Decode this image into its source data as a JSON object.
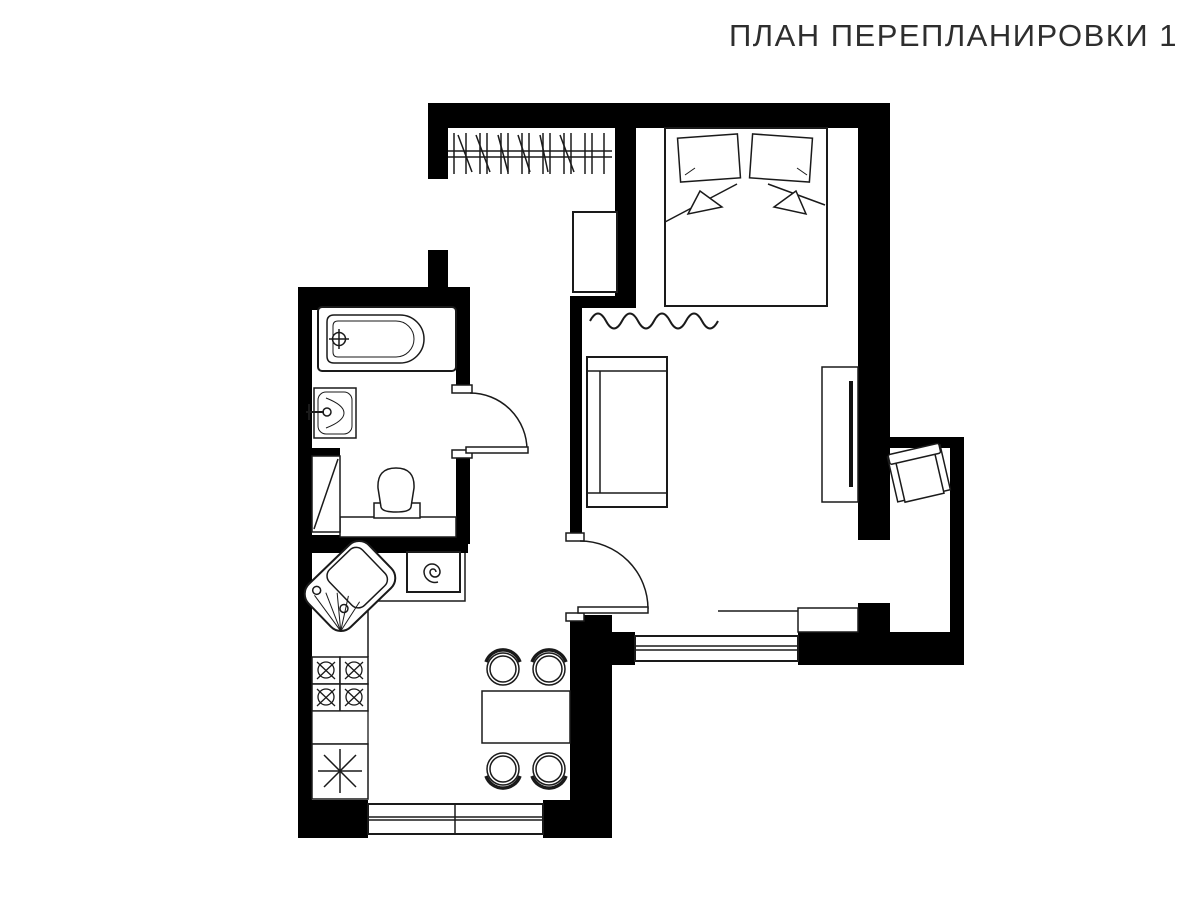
{
  "header": {
    "title": "ПЛАН ПЕРЕПЛАНИРОВКИ 1"
  },
  "colors": {
    "walls": "#000000",
    "furniture_lines": "#1a1a1a",
    "background": "#ffffff"
  },
  "floor_plan": {
    "type": "apartment-replanning-plan",
    "sheet_number": "1",
    "rooms": [
      {
        "name": "hallway",
        "fixtures": [
          "wardrobe-hanger-rail",
          "dresser"
        ]
      },
      {
        "name": "bedroom",
        "fixtures": [
          "double-bed",
          "pillow-left",
          "pillow-right",
          "blanket-folds"
        ]
      },
      {
        "name": "bathroom",
        "fixtures": [
          "bathtub",
          "bathtub-faucet",
          "washbasin",
          "toilet",
          "vent-shaft"
        ]
      },
      {
        "name": "kitchen",
        "fixtures": [
          "corner-sink",
          "washing-machine",
          "stove-four-burners",
          "base-cabinet",
          "refrigerator",
          "counter"
        ]
      },
      {
        "name": "dining-area",
        "fixtures": [
          "dining-table",
          "chair",
          "chair",
          "chair",
          "chair"
        ]
      },
      {
        "name": "living-room",
        "fixtures": [
          "sofa",
          "tv-console",
          "tv",
          "curtain-divider",
          "radiator"
        ]
      },
      {
        "name": "balcony",
        "fixtures": [
          "armchair"
        ]
      }
    ],
    "openings": [
      "entrance-opening",
      "bathroom-door",
      "kitchen-door",
      "balcony-opening",
      "living-room-window",
      "kitchen-window"
    ]
  }
}
